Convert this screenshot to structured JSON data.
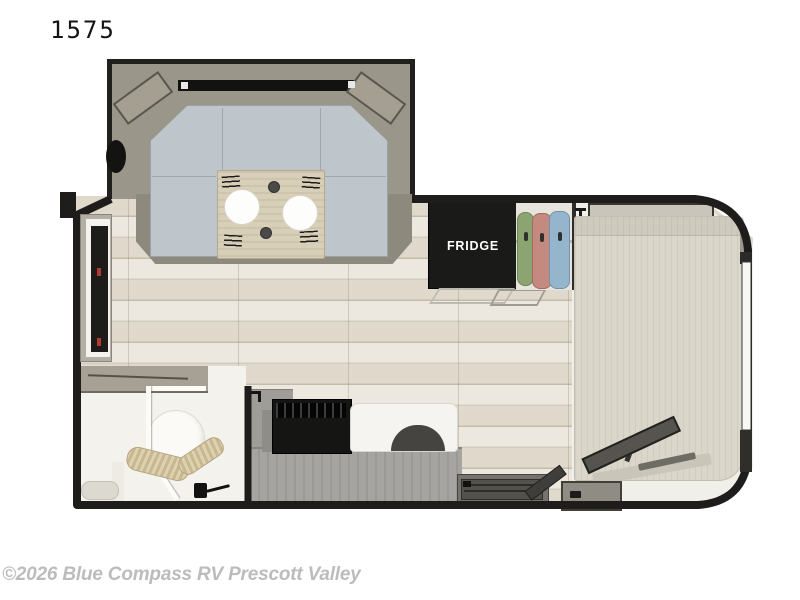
{
  "header": {
    "model_number": "1575"
  },
  "floorplan": {
    "labels": {
      "fridge": "FRIDGE"
    },
    "features": [
      "u-shaped-dinette",
      "dinette-table-with-place-settings",
      "porthole-window",
      "refrigerator",
      "wardrobe-closet",
      "overhead-shelf",
      "rv-bed",
      "tv-on-stand",
      "wet-bath",
      "toilet",
      "shower-enclosure",
      "towels",
      "kitchen-counter",
      "cooktop",
      "sink",
      "entry-door",
      "entry-step-well",
      "storage-step-box"
    ],
    "colors": {
      "walls": "#1e1d1b",
      "floor": "#e9e4d9",
      "dinette_cushions": "#bec5cb",
      "table": "#d8cfb9",
      "fridge": "#1a1a19",
      "mattress": "#dad6ca",
      "clothes_green": "#8ca471",
      "clothes_pink": "#c48a80",
      "clothes_blue": "#94b5cc"
    }
  },
  "watermark": {
    "text": "©2026 Blue Compass RV Prescott Valley"
  }
}
